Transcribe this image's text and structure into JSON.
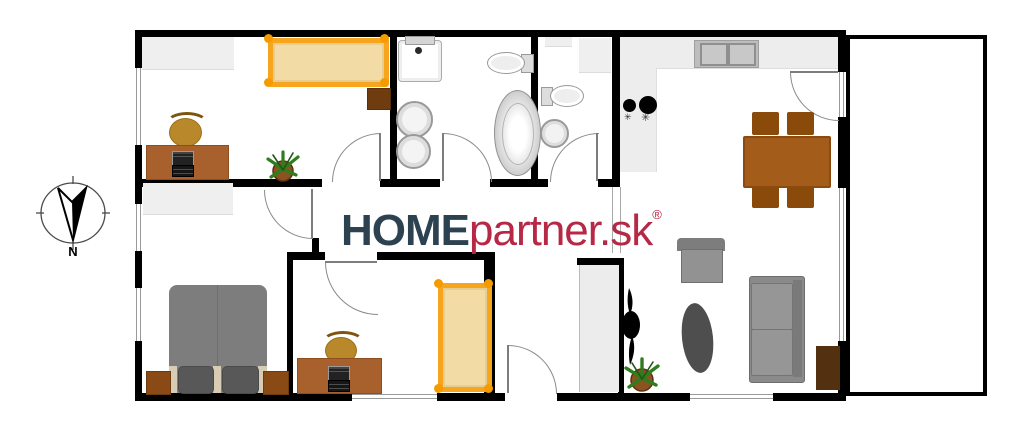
{
  "logo": {
    "home": "HOME",
    "partner": "partner.sk",
    "reg": "®",
    "home_color": "#2d4250",
    "partner_color": "#b72746"
  },
  "compass": {
    "label": "N"
  },
  "kitchen": {
    "burner_symbol": "✳"
  },
  "palette": {
    "wall": "#000000",
    "window_frame": "#9a9a9a",
    "door_arc": "#8a8a8a",
    "bed_frame_orange": "#f7a51c",
    "mattress_tan": "#f3dba6",
    "desk_wood": "#a8602c",
    "table_wood": "#a35c1a",
    "chair_wood": "#8a4a0a",
    "tv_cabinet_wood": "#53300f",
    "nightstand_wood": "#8a4a16",
    "cabinet_gray": "#efefef",
    "sofa_gray": "#8a8a8a",
    "double_bed_gray": "#7d7d7d",
    "rug_gray": "#4e4e4e",
    "plant_green": "#2e7d1e",
    "pot_brown": "#7a4a1a"
  }
}
